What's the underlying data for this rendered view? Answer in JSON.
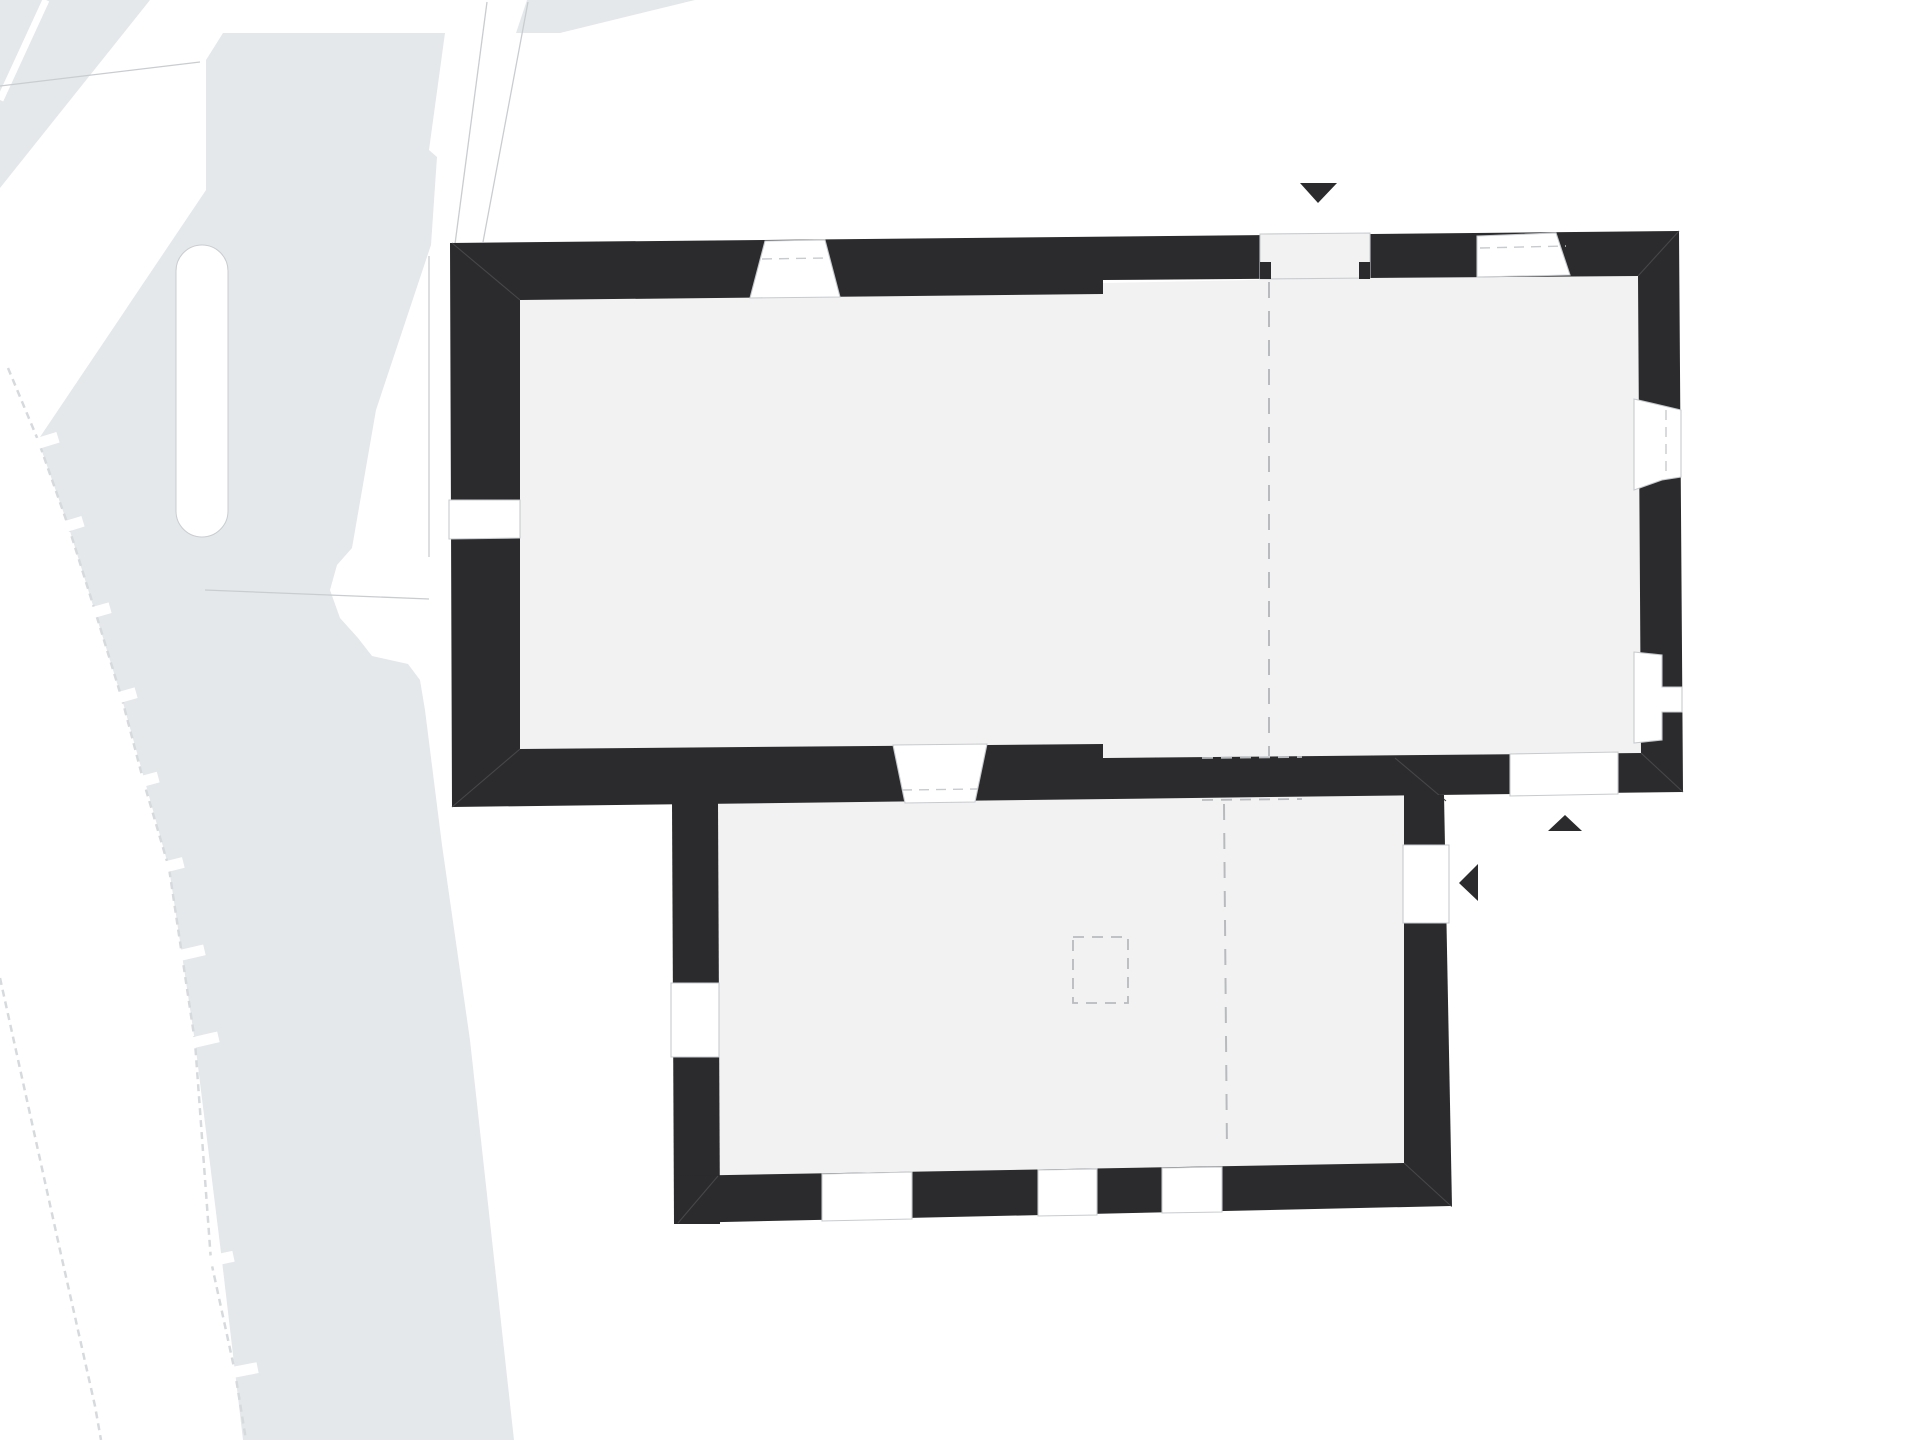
{
  "page": {
    "kind": "architectural plan drawing",
    "description": "Black-poche ground floor plan of two adjoining rectangular halls on a light gray site map, no visible text"
  },
  "palette": {
    "background": "#ffffff",
    "site_fill": "#e4e8eb",
    "site_line": "#d6dadc",
    "plot_line": "#c9cdd0",
    "wall_fill": "#2b2b2d",
    "wall_miter_line": "#47474a",
    "room_fill": "#f2f2f3",
    "opening_fill": "#ffffff",
    "opening_line": "#c7cbce",
    "dash_line": "#b7bbbe",
    "marker_fill": "#2b2b2d"
  },
  "plan": {
    "upper_hall": {
      "walls": "solid black poche",
      "top_wall_openings": {
        "splayed_windows": 2,
        "entrance_door": 1
      },
      "right_wall_openings": {
        "splayed_windows": 2
      },
      "bottom_wall_openings": {
        "splayed_window": 1,
        "door": 1,
        "dashed_passage": 1
      },
      "left_wall_openings": {
        "window": 1
      },
      "axis": "vertical dashed center line"
    },
    "lower_hall": {
      "walls": "solid black poche",
      "left_wall_openings": {
        "window": 1
      },
      "right_wall_openings": {
        "door": 1
      },
      "bottom_wall_openings": {
        "gaps": 3
      },
      "axis": "vertical dashed center line",
      "dashed_pillar_outline": 1
    },
    "markers": {
      "north_entrance_arrow": {
        "shape": "triangle",
        "direction": "down"
      },
      "south_entrance_arrow": {
        "shape": "triangle",
        "direction": "up"
      },
      "east_entrance_arrow": {
        "shape": "triangle",
        "direction": "left"
      }
    },
    "site_context": {
      "blocks": "light gray urban blocks with white streets",
      "boundary_ticks": 10,
      "dashed_survey_lines": 2,
      "dead_end_lane": 1
    }
  }
}
